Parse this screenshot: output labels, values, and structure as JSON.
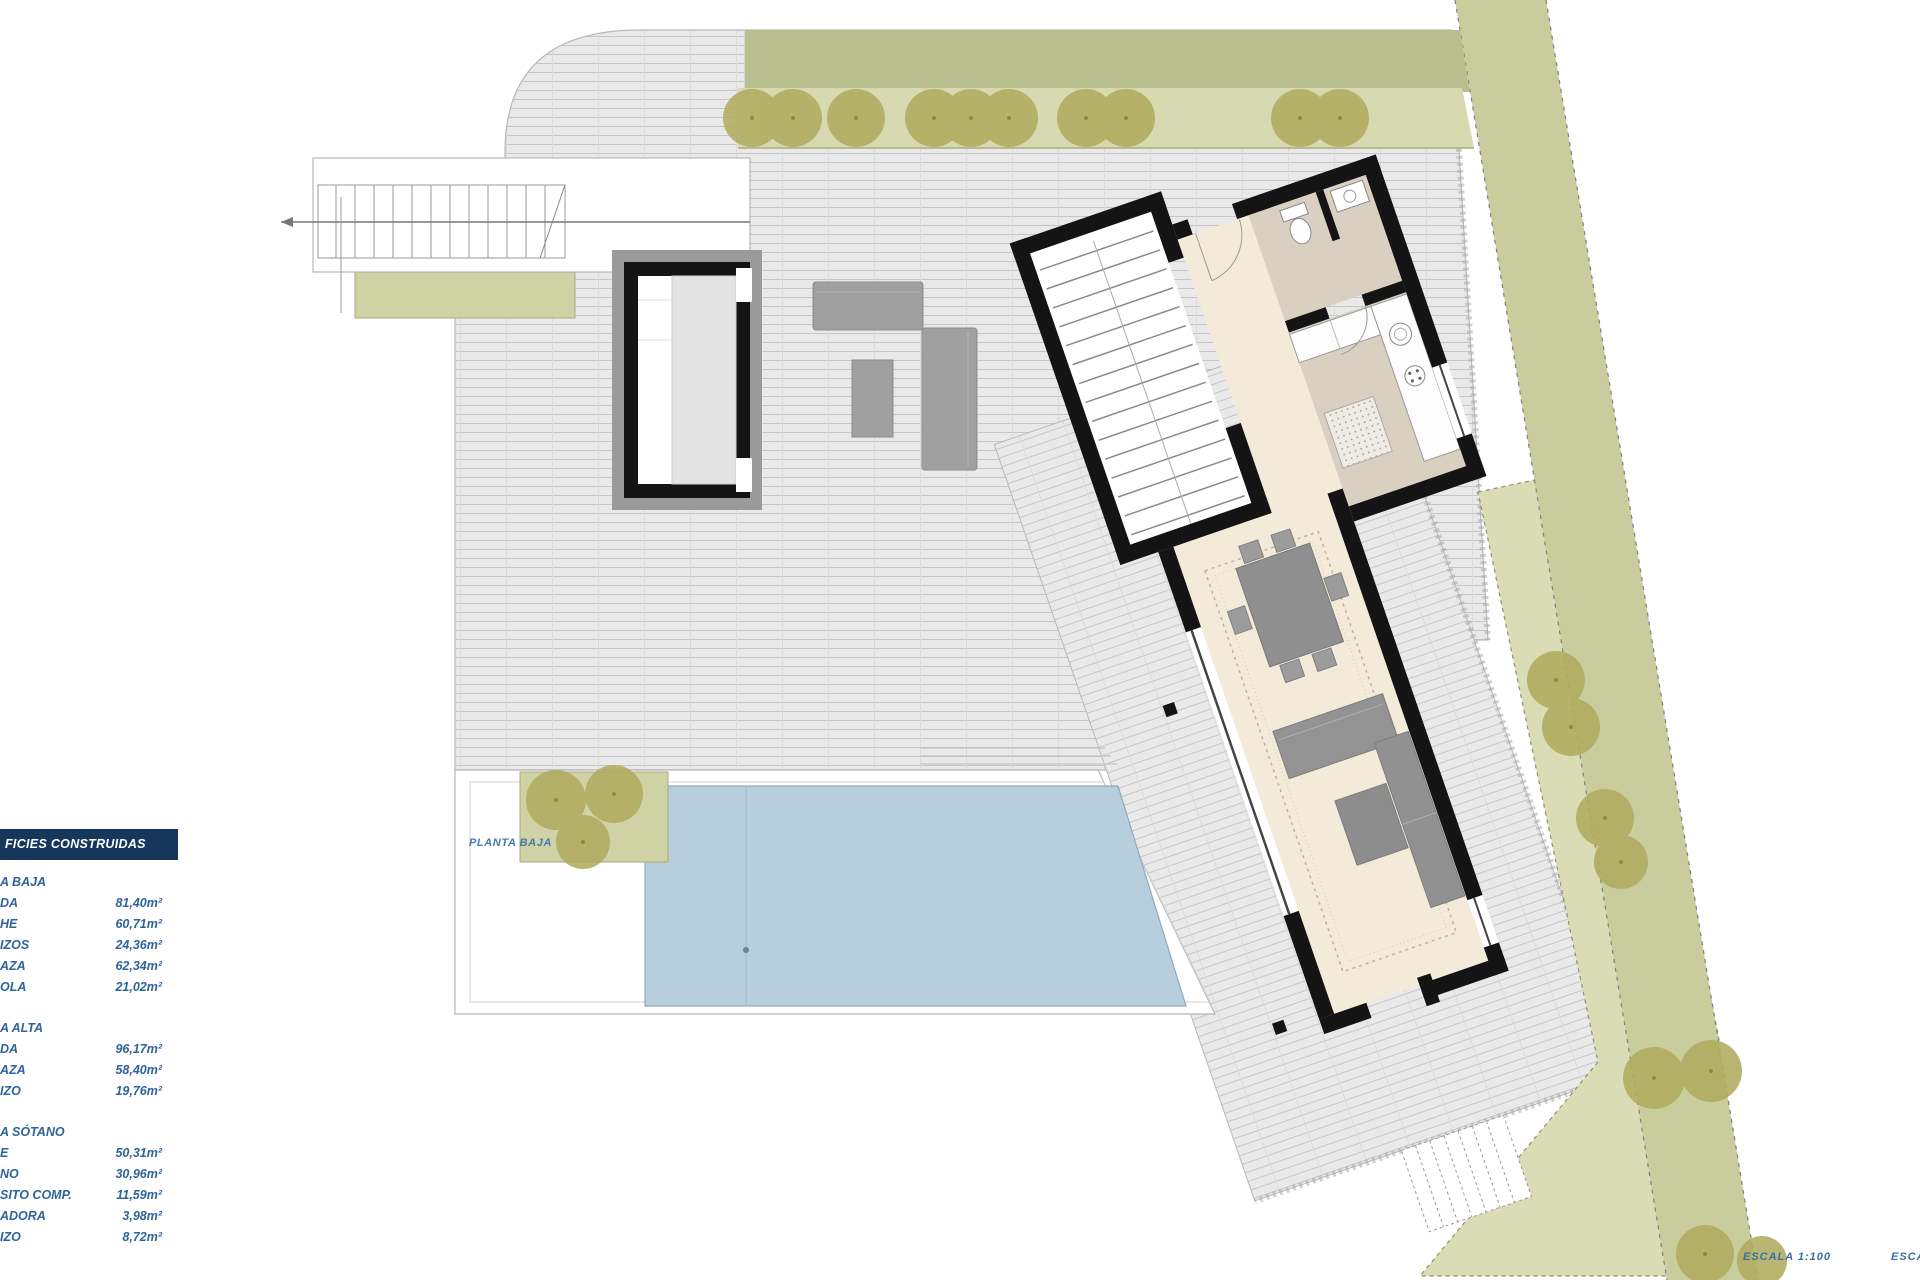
{
  "plan": {
    "floor_label": "PLANTA BAJA",
    "scale_label": "ESCALA  1:100",
    "scale_label_right_edge": "ESCALA"
  },
  "areas_panel": {
    "title": "FICIES CONSTRUIDAS",
    "sections": [
      {
        "name": "A BAJA",
        "rows": [
          {
            "label": "DA",
            "value": "81,40m²"
          },
          {
            "label": "HE",
            "value": "60,71m²"
          },
          {
            "label": "IZOS",
            "value": "24,36m²"
          },
          {
            "label": "AZA",
            "value": "62,34m²"
          },
          {
            "label": "OLA",
            "value": "21,02m²"
          }
        ]
      },
      {
        "name": "A ALTA",
        "rows": [
          {
            "label": "DA",
            "value": "96,17m²"
          },
          {
            "label": "AZA",
            "value": "58,40m²"
          },
          {
            "label": "IZO",
            "value": "19,76m²"
          }
        ]
      },
      {
        "name": "A SÓTANO",
        "rows": [
          {
            "label": "E",
            "value": "50,31m²"
          },
          {
            "label": "NO",
            "value": "30,96m²"
          },
          {
            "label": "SITO COMP.",
            "value": "11,59m²"
          },
          {
            "label": "ADORA",
            "value": "3,98m²"
          },
          {
            "label": "IZO",
            "value": "8,72m²"
          }
        ]
      }
    ]
  },
  "colors": {
    "panel_header_bg": "#16365c",
    "panel_text": "#2e639c",
    "plan_label_text": "#4879a9",
    "terrace_fill": "#e9e9e9",
    "hatch_line": "#c6c6c6",
    "pool_fill": "#b7cedd",
    "garden_fill": "#dadcb6",
    "boundary_band_fill": "#c9cd9e",
    "top_band_fill": "#b9bf8e",
    "tree_fill": "#b1ac5f",
    "planter_fill": "#ced2a4",
    "hall_floor": "#f4ead9",
    "wet_room_floor": "#d9d0c2",
    "wall": "#141414",
    "furniture": "#919191"
  }
}
